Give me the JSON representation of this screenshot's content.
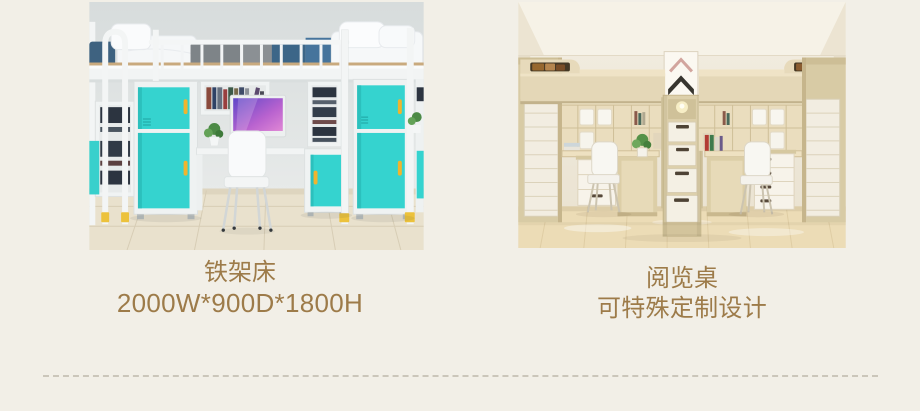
{
  "page": {
    "background": "#f2efe7"
  },
  "products": [
    {
      "title": "铁架床",
      "subtitle": "2000W*900D*1800H",
      "photo": "metal-frame-bunk-bed-with-desk-and-teal-lockers"
    },
    {
      "title": "阅览桌",
      "subtitle": "可特殊定制设计",
      "photo": "wooden-loft-bunks-with-reading-desks-and-stair-drawers"
    }
  ],
  "colors": {
    "caption_text": "#9d7b49",
    "divider": "#cbc6ba",
    "teal_cabinet": "#35d3cf",
    "handle_yellow": "#f0b42e",
    "wood": "#e4d7b7"
  }
}
